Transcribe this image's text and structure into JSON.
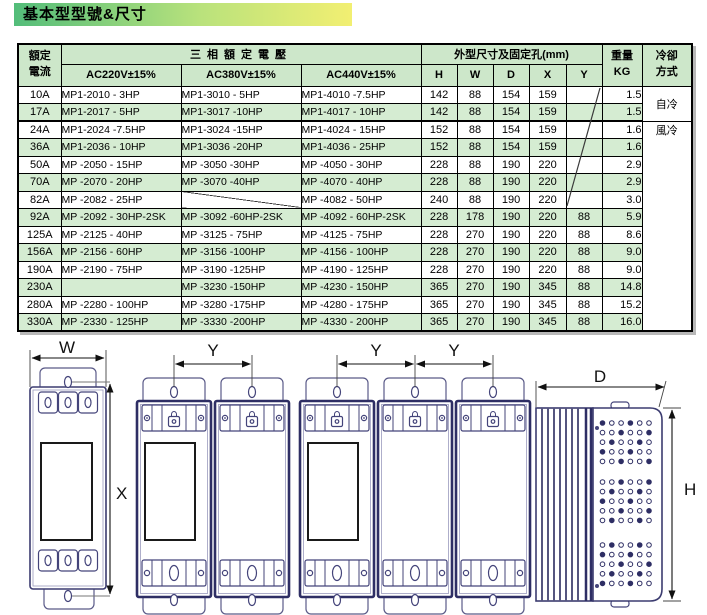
{
  "title": "基本型型號&尺寸",
  "colors": {
    "title_grad_start": "#53bd7a",
    "title_grad_end": "#f2ef72",
    "header_green": "#cde7ca",
    "row_green": "#d5ecd2"
  },
  "table": {
    "header": {
      "current_line1": "額定",
      "current_line2": "電流",
      "voltage_group": "三相額定電壓",
      "voltage_cols": [
        "AC220V±15%",
        "AC380V±15%",
        "AC440V±15%"
      ],
      "dims_group": "外型尺寸及固定孔(mm)",
      "dim_cols": [
        "H",
        "W",
        "D",
        "X",
        "Y"
      ],
      "weight_line1": "重量",
      "weight_line2": "KG",
      "cooling_line1": "冷卻",
      "cooling_line2": "方式"
    },
    "cooling_labels": {
      "self": "自冷",
      "fan": "風冷"
    },
    "rows": [
      {
        "current": "10A",
        "ac220": "MP1-2010 -  3HP",
        "ac380": "MP1-3010 -  5HP",
        "ac440": "MP1-4010 -7.5HP",
        "h": "142",
        "w": "88",
        "d": "154",
        "x": "159",
        "y": "",
        "kg": "1.5"
      },
      {
        "current": "17A",
        "ac220": "MP1-2017 -  5HP",
        "ac380": "MP1-3017 -10HP",
        "ac440": "MP1-4017 - 10HP",
        "h": "142",
        "w": "88",
        "d": "154",
        "x": "159",
        "y": "",
        "kg": "1.5"
      },
      {
        "current": "24A",
        "ac220": "MP1-2024 -7.5HP",
        "ac380": "MP1-3024 -15HP",
        "ac440": "MP1-4024 - 15HP",
        "h": "152",
        "w": "88",
        "d": "154",
        "x": "159",
        "y": "",
        "kg": "1.6"
      },
      {
        "current": "36A",
        "ac220": "MP1-2036 - 10HP",
        "ac380": "MP1-3036 -20HP",
        "ac440": "MP1-4036 - 25HP",
        "h": "152",
        "w": "88",
        "d": "154",
        "x": "159",
        "y": "",
        "kg": "1.6"
      },
      {
        "current": "50A",
        "ac220": "MP -2050 - 15HP",
        "ac380": "MP -3050 -30HP",
        "ac440": "MP -4050 - 30HP",
        "h": "228",
        "w": "88",
        "d": "190",
        "x": "220",
        "y": "",
        "kg": "2.9"
      },
      {
        "current": "70A",
        "ac220": "MP -2070 - 20HP",
        "ac380": "MP -3070 -40HP",
        "ac440": "MP -4070 - 40HP",
        "h": "228",
        "w": "88",
        "d": "190",
        "x": "220",
        "y": "",
        "kg": "2.9"
      },
      {
        "current": "82A",
        "ac220": "MP -2082 - 25HP",
        "ac380": null,
        "ac440": "MP -4082 - 50HP",
        "h": "240",
        "w": "88",
        "d": "190",
        "x": "220",
        "y": "",
        "kg": "3.0"
      },
      {
        "current": "92A",
        "ac220": "MP -2092 - 30HP-2SK",
        "ac380": "MP -3092 -60HP-2SK",
        "ac440": "MP -4092 - 60HP-2SK",
        "h": "228",
        "w": "178",
        "d": "190",
        "x": "220",
        "y": "88",
        "kg": "5.9"
      },
      {
        "current": "125A",
        "ac220": "MP -2125 - 40HP",
        "ac380": "MP -3125 - 75HP",
        "ac440": "MP -4125 -  75HP",
        "h": "228",
        "w": "270",
        "d": "190",
        "x": "220",
        "y": "88",
        "kg": "8.6"
      },
      {
        "current": "156A",
        "ac220": "MP -2156 - 60HP",
        "ac380": "MP -3156 -100HP",
        "ac440": "MP -4156 - 100HP",
        "h": "228",
        "w": "270",
        "d": "190",
        "x": "220",
        "y": "88",
        "kg": "9.0"
      },
      {
        "current": "190A",
        "ac220": "MP -2190 - 75HP",
        "ac380": "MP -3190 -125HP",
        "ac440": "MP -4190 - 125HP",
        "h": "228",
        "w": "270",
        "d": "190",
        "x": "220",
        "y": "88",
        "kg": "9.0"
      },
      {
        "current": "230A",
        "ac220": null,
        "ac380": "MP -3230 -150HP",
        "ac440": "MP -4230 - 150HP",
        "h": "365",
        "w": "270",
        "d": "190",
        "x": "345",
        "y": "88",
        "kg": "14.8"
      },
      {
        "current": "280A",
        "ac220": "MP -2280 - 100HP",
        "ac380": "MP -3280 -175HP",
        "ac440": "MP -4280 - 175HP",
        "h": "365",
        "w": "270",
        "d": "190",
        "x": "345",
        "y": "88",
        "kg": "15.2"
      },
      {
        "current": "330A",
        "ac220": "MP -2330 - 125HP",
        "ac380": "MP -3330 -200HP",
        "ac440": "MP -4330 - 200HP",
        "h": "365",
        "w": "270",
        "d": "190",
        "x": "345",
        "y": "88",
        "kg": "16.0"
      }
    ]
  },
  "diagrams": {
    "front_view_width_label": "W",
    "front_view_hole_pitch_vertical_label": "X",
    "hole_pitch_labels": [
      "Y",
      "Y",
      "Y"
    ],
    "side_view_depth_label": "D",
    "side_view_height_label": "H"
  }
}
